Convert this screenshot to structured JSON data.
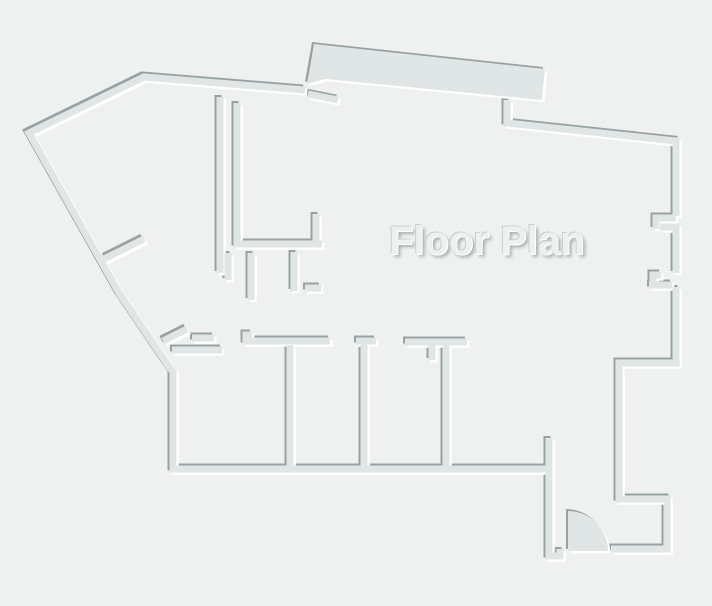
{
  "floor_plan": {
    "label": "Floor Plan",
    "elements": {
      "door_swing": "quarter-circle door swing arc at bottom-right entrance"
    },
    "colors": {
      "background": "#eff1f1",
      "wall": "#e0e5e5",
      "wall_shadow": "#99a2a2",
      "wall_highlight": "#ffffff",
      "label_text": "#edf0f0",
      "label_shadow_dark": "#a8afaf",
      "label_hairline": "#c9cfcf",
      "label_highlight": "#ffffff"
    }
  }
}
